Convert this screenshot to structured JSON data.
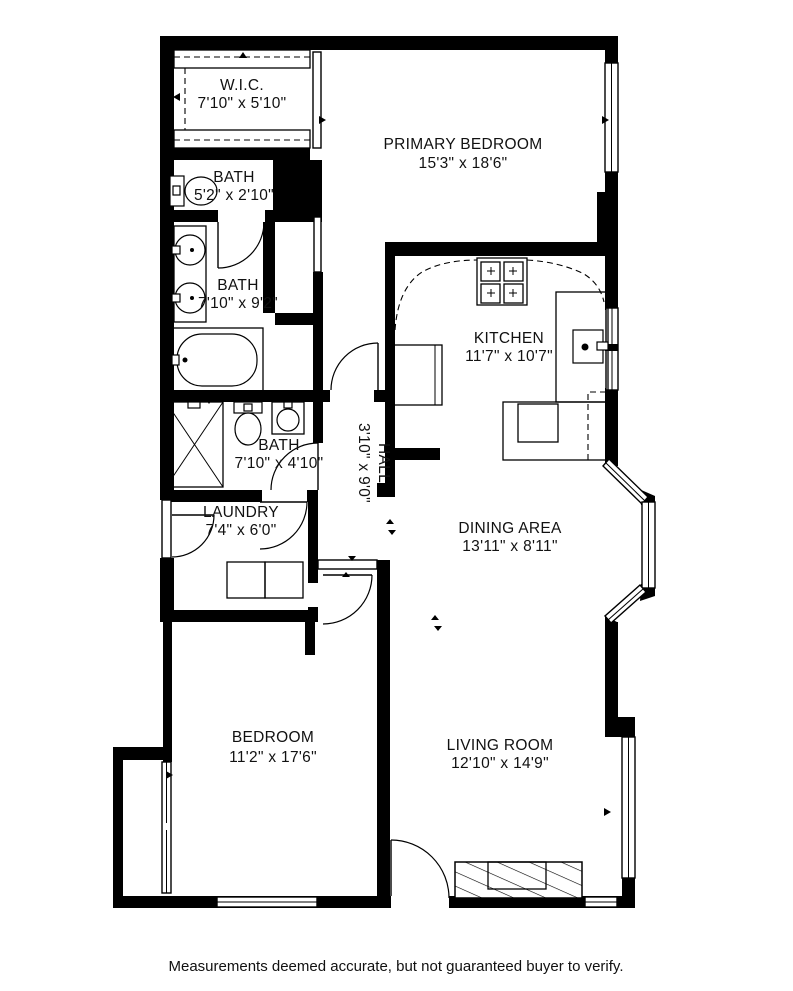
{
  "rooms": [
    {
      "id": "wic",
      "name": "W.I.C.",
      "dims": "7'10\" x 5'10\""
    },
    {
      "id": "bath-1",
      "name": "BATH",
      "dims": "5'2\" x 2'10\""
    },
    {
      "id": "bath-2",
      "name": "BATH",
      "dims": "7'10\" x 9'2\""
    },
    {
      "id": "bath-3",
      "name": "BATH",
      "dims": "7'10\" x 4'10\""
    },
    {
      "id": "laundry",
      "name": "LAUNDRY",
      "dims": "7'4\" x 6'0\""
    },
    {
      "id": "hall",
      "name": "HALL",
      "dims": "3'10\" x 9'0\""
    },
    {
      "id": "primary-bedroom",
      "name": "PRIMARY BEDROOM",
      "dims": "15'3\" x 18'6\""
    },
    {
      "id": "kitchen",
      "name": "KITCHEN",
      "dims": "11'7\" x 10'7\""
    },
    {
      "id": "dining",
      "name": "DINING AREA",
      "dims": "13'11\" x 8'11\""
    },
    {
      "id": "bedroom",
      "name": "BEDROOM",
      "dims": "11'2\" x 17'6\""
    },
    {
      "id": "living",
      "name": "LIVING ROOM",
      "dims": "12'10\" x 14'9\""
    }
  ],
  "disclaimer": "Measurements deemed accurate, but not guaranteed buyer to verify.",
  "colors": {
    "wall": "#000000",
    "background": "#ffffff",
    "line": "#111111"
  },
  "fixtures": [
    "bathtub-icon",
    "shower-icon",
    "toilet-icon",
    "sink-icon",
    "double-vanity-icon",
    "washer-icon",
    "dryer-icon",
    "stove-icon",
    "kitchen-sink-icon",
    "refrigerator-icon",
    "fireplace-icon",
    "closet-rod-icon",
    "door-swing-icon",
    "window-icon",
    "bay-window-icon"
  ]
}
